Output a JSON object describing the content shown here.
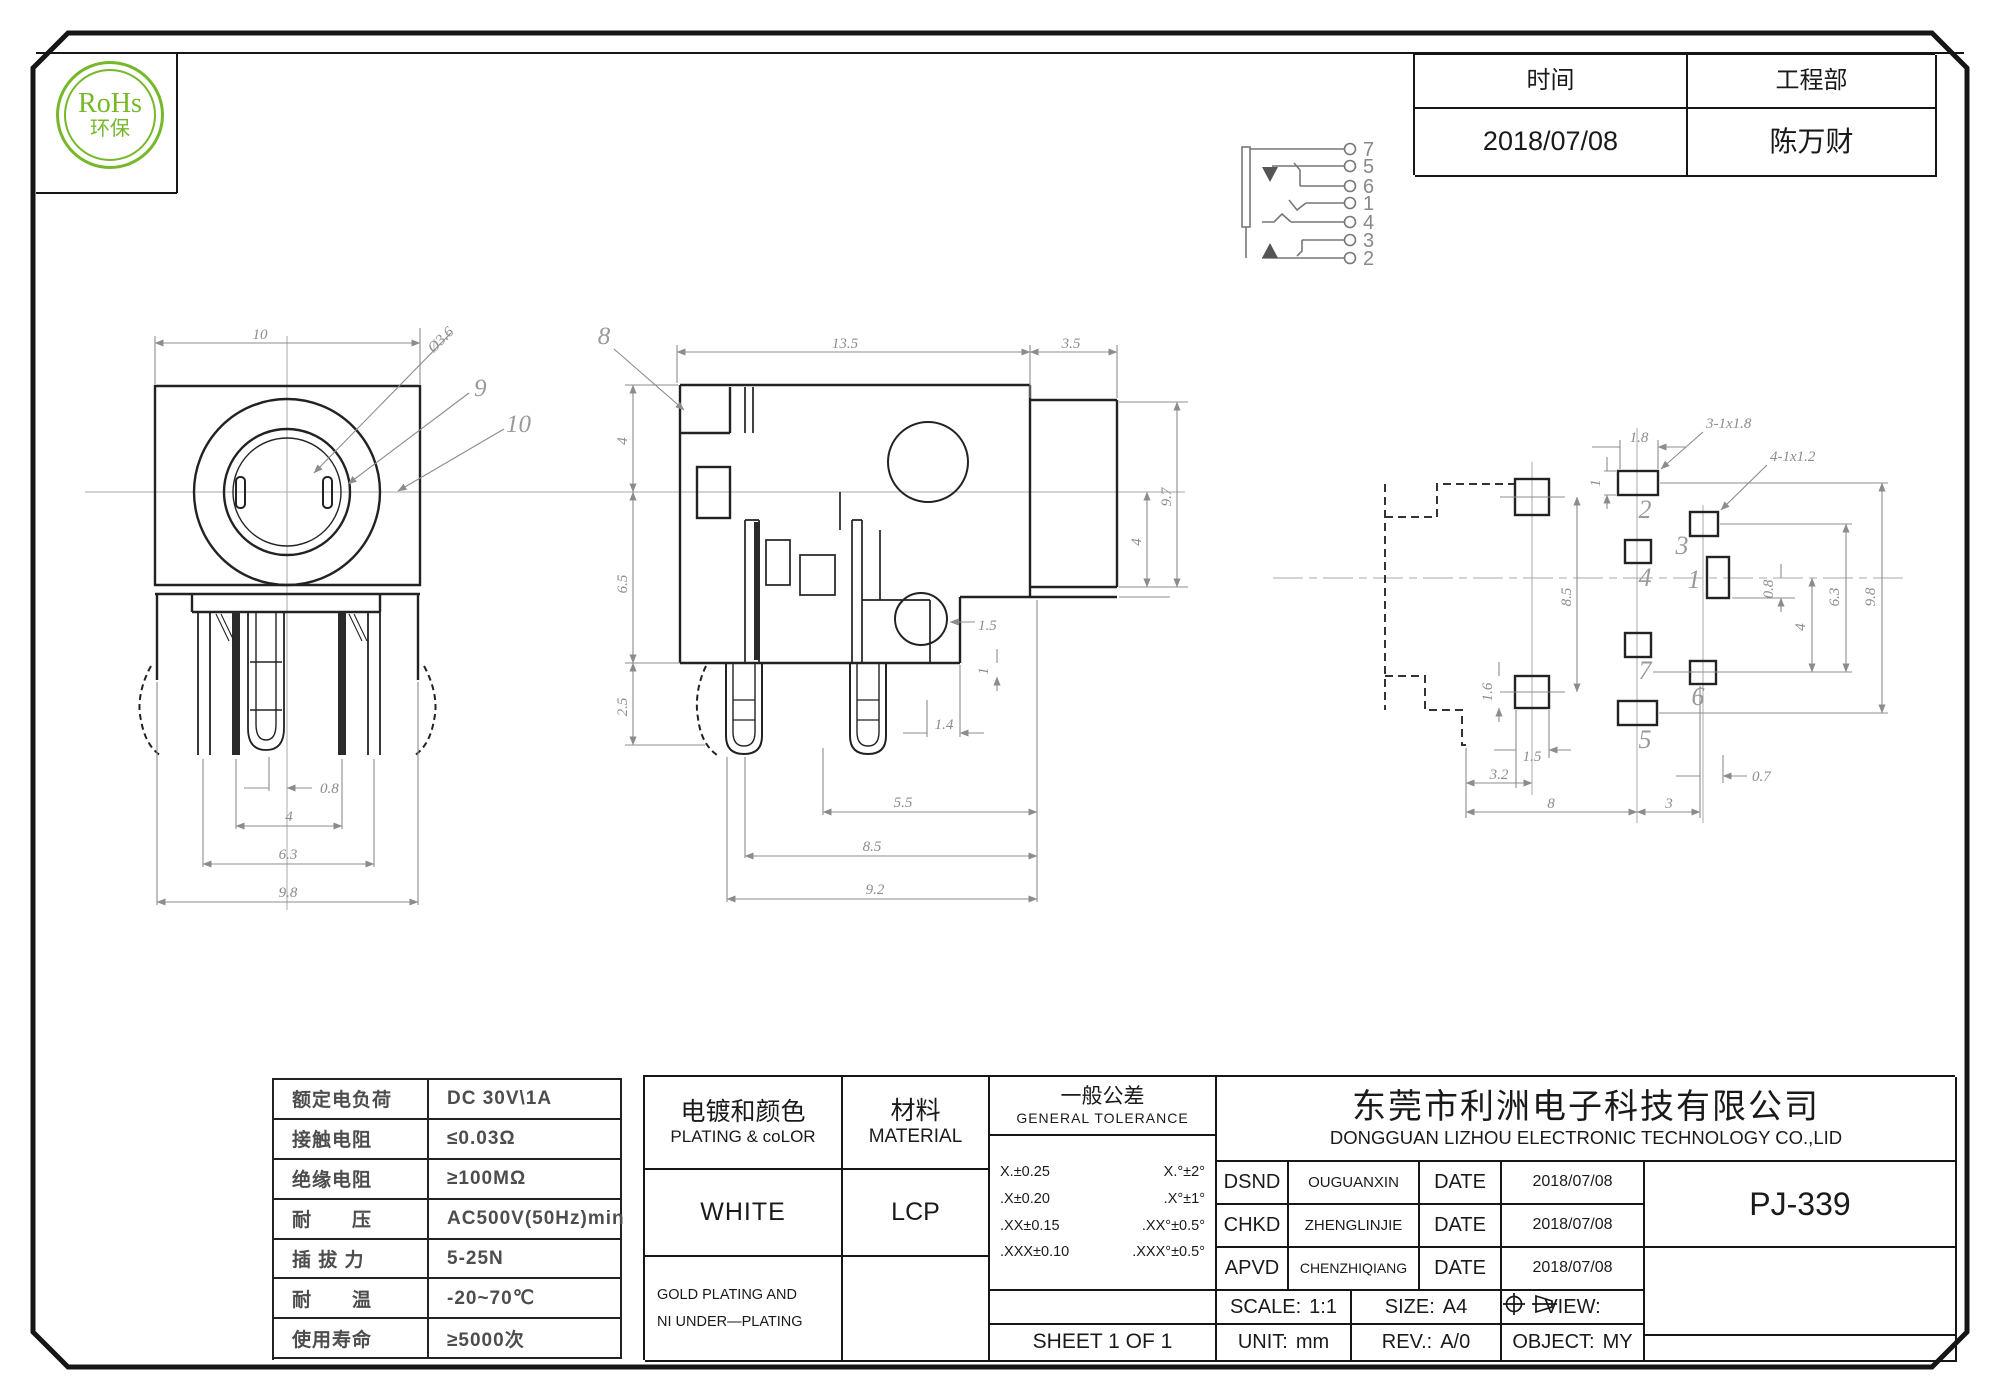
{
  "rohs": {
    "title": "RoHs",
    "subtitle": "环保",
    "color": "#76b82a"
  },
  "header_table": {
    "time_label": "时间",
    "dept_label": "工程部",
    "time_value": "2018/07/08",
    "dept_value": "陈万财"
  },
  "schematic": {
    "pins": [
      "7",
      "5",
      "6",
      "1",
      "4",
      "3",
      "2"
    ]
  },
  "drawing": {
    "front": {
      "dim_top": "10",
      "dia": "Ø3.6",
      "ref_9": "9",
      "ref_10": "10",
      "dim_08": "0.8",
      "dim_4": "4",
      "dim_63": "6.3",
      "dim_98": "9.8"
    },
    "side": {
      "ref_8": "8",
      "dim_135": "13.5",
      "dim_35": "3.5",
      "dim_4l": "4",
      "dim_65": "6.5",
      "dim_25": "2.5",
      "dim_97": "9.7",
      "dim_4r": "4",
      "dim_15": "1.5",
      "dim_1": "1",
      "dim_14": "1.4",
      "dim_55": "5.5",
      "dim_85": "8.5",
      "dim_92": "9.2"
    },
    "pcb": {
      "pad_1": "1",
      "pad_2": "2",
      "pad_3": "3",
      "pad_4": "4",
      "pad_5": "5",
      "pad_6": "6",
      "pad_7": "7",
      "note_3": "3-1x1.8",
      "note_4": "4-1x1.2",
      "dim_18": "1.8",
      "dim_1": "1",
      "dim_85": "8.5",
      "dim_16": "1.6",
      "dim_15": "1.5",
      "dim_32": "3.2",
      "dim_8": "8",
      "dim_3": "3",
      "dim_07": "0.7",
      "dim_08": "0.8",
      "dim_4": "4",
      "dim_63": "6.3",
      "dim_98": "9.8"
    }
  },
  "spec_table": {
    "rows": [
      {
        "label": "额定电负荷",
        "value": "DC 30V\\1A"
      },
      {
        "label": "接触电阻",
        "value": "≤0.03Ω"
      },
      {
        "label": "绝缘电阻",
        "value": "≥100MΩ"
      },
      {
        "label": "耐　　压",
        "value": "AC500V(50Hz)min"
      },
      {
        "label": "插 拔 力",
        "value": "5-25N"
      },
      {
        "label": "耐　　温",
        "value": "-20~70℃"
      },
      {
        "label": "使用寿命",
        "value": "≥5000次"
      }
    ]
  },
  "title_block": {
    "plating": {
      "zh": "电镀和颜色",
      "en": "PLATING & coLOR",
      "value": "WHITE",
      "note_line1": "GOLD PLATING AND",
      "note_line2": "NI UNDER—PLATING"
    },
    "material": {
      "zh": "材料",
      "en": "MATERIAL",
      "value": "LCP"
    },
    "tolerance": {
      "zh": "一般公差",
      "en": "GENERAL TOLERANCE",
      "rows": [
        [
          "X.±0.25",
          "X.°±2°"
        ],
        [
          ".X±0.20",
          ".X°±1°"
        ],
        [
          ".XX±0.15",
          ".XX°±0.5°"
        ],
        [
          ".XXX±0.10",
          ".XXX°±0.5°"
        ]
      ],
      "sheet": "SHEET 1 OF 1"
    },
    "company": {
      "zh": "东莞市利洲电子科技有限公司",
      "en": "DONGGUAN LIZHOU ELECTRONIC TECHNOLOGY CO.,LID"
    },
    "signoff": [
      {
        "role": "DSND",
        "name": "OUGUANXIN",
        "date_label": "DATE",
        "date": "2018/07/08"
      },
      {
        "role": "CHKD",
        "name": "ZHENGLINJIE",
        "date_label": "DATE",
        "date": "2018/07/08"
      },
      {
        "role": "APVD",
        "name": "CHENZHIQIANG",
        "date_label": "DATE",
        "date": "2018/07/08"
      }
    ],
    "info": {
      "scale_label": "SCALE:",
      "scale": "1:1",
      "size_label": "SIZE:",
      "size": "A4",
      "view_label": "VIEW:",
      "unit_label": "UNIT:",
      "unit": "mm",
      "rev_label": "REV.:",
      "rev": "A/0",
      "object_label": "OBJECT:",
      "object": "MY"
    },
    "part_number": "PJ-339"
  }
}
